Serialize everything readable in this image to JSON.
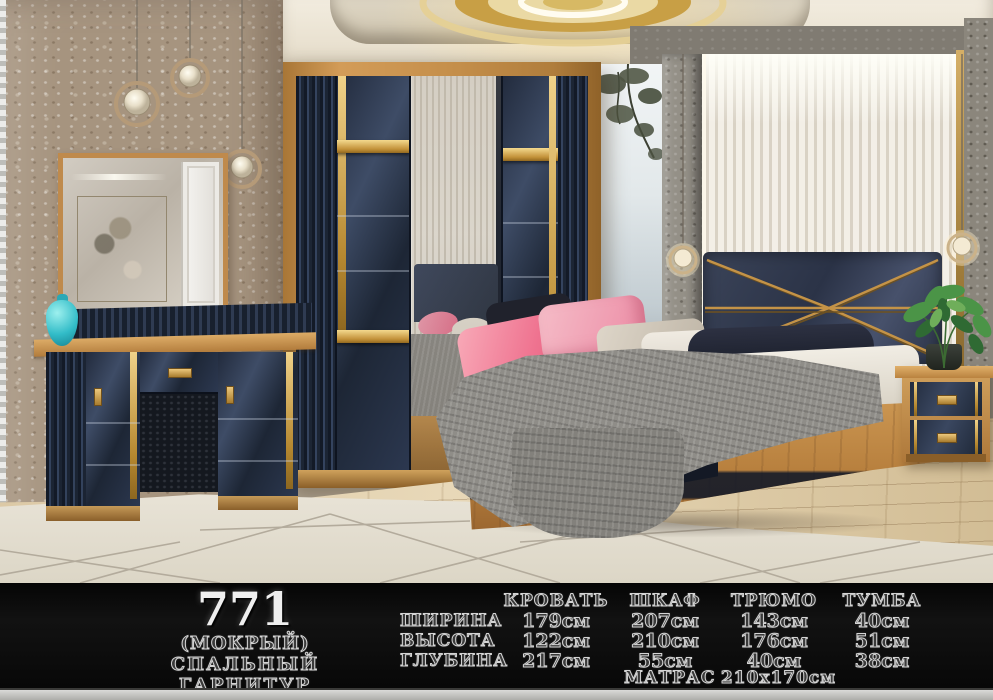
{
  "banner": {
    "model": "771",
    "variant": "(МОКРЫЙ)",
    "product_type": "СПАЛЬНЫЙ ГАРНИТУР",
    "table": {
      "columns": [
        "КРОВАТЬ",
        "ШКАФ",
        "ТРЮМО",
        "ТУМБА"
      ],
      "rows": [
        {
          "label": "ШИРИНА",
          "values": [
            "179см",
            "207см",
            "143см",
            "40см"
          ]
        },
        {
          "label": "ВЫСОТА",
          "values": [
            "122см",
            "210см",
            "176см",
            "51см"
          ]
        },
        {
          "label": "ГЛУБИНА",
          "values": [
            "217см",
            "55см",
            "40см",
            "38см"
          ]
        }
      ],
      "mattress_label": "МАТРАС",
      "mattress_value": "210х170см"
    }
  },
  "colors": {
    "banner_background": "#0a0a0a",
    "etched_text": "#d4d4d4",
    "model_text": "#efefef",
    "gold_accent": "#c99a4b",
    "navy_furniture": "#2a3345",
    "wood": "#c08a4d",
    "vase_teal": "#35c0cc"
  }
}
